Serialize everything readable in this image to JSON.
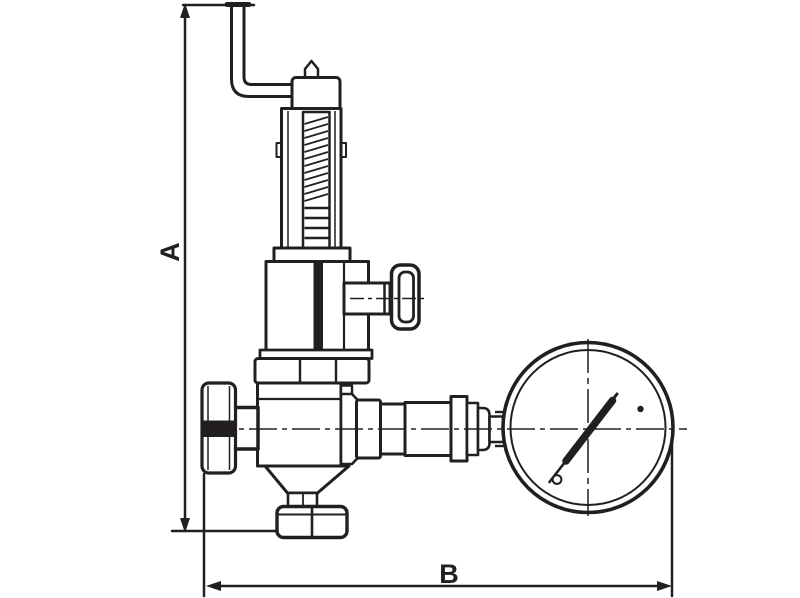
{
  "figure": {
    "kind": "technical-drawing",
    "subject": "pressure reducing valve with pressure gauge, side view outline drawing"
  },
  "labels": {
    "dim_a": "A",
    "dim_b": "B"
  },
  "colors": {
    "ink": "#231f20",
    "background": "#ffffff"
  }
}
